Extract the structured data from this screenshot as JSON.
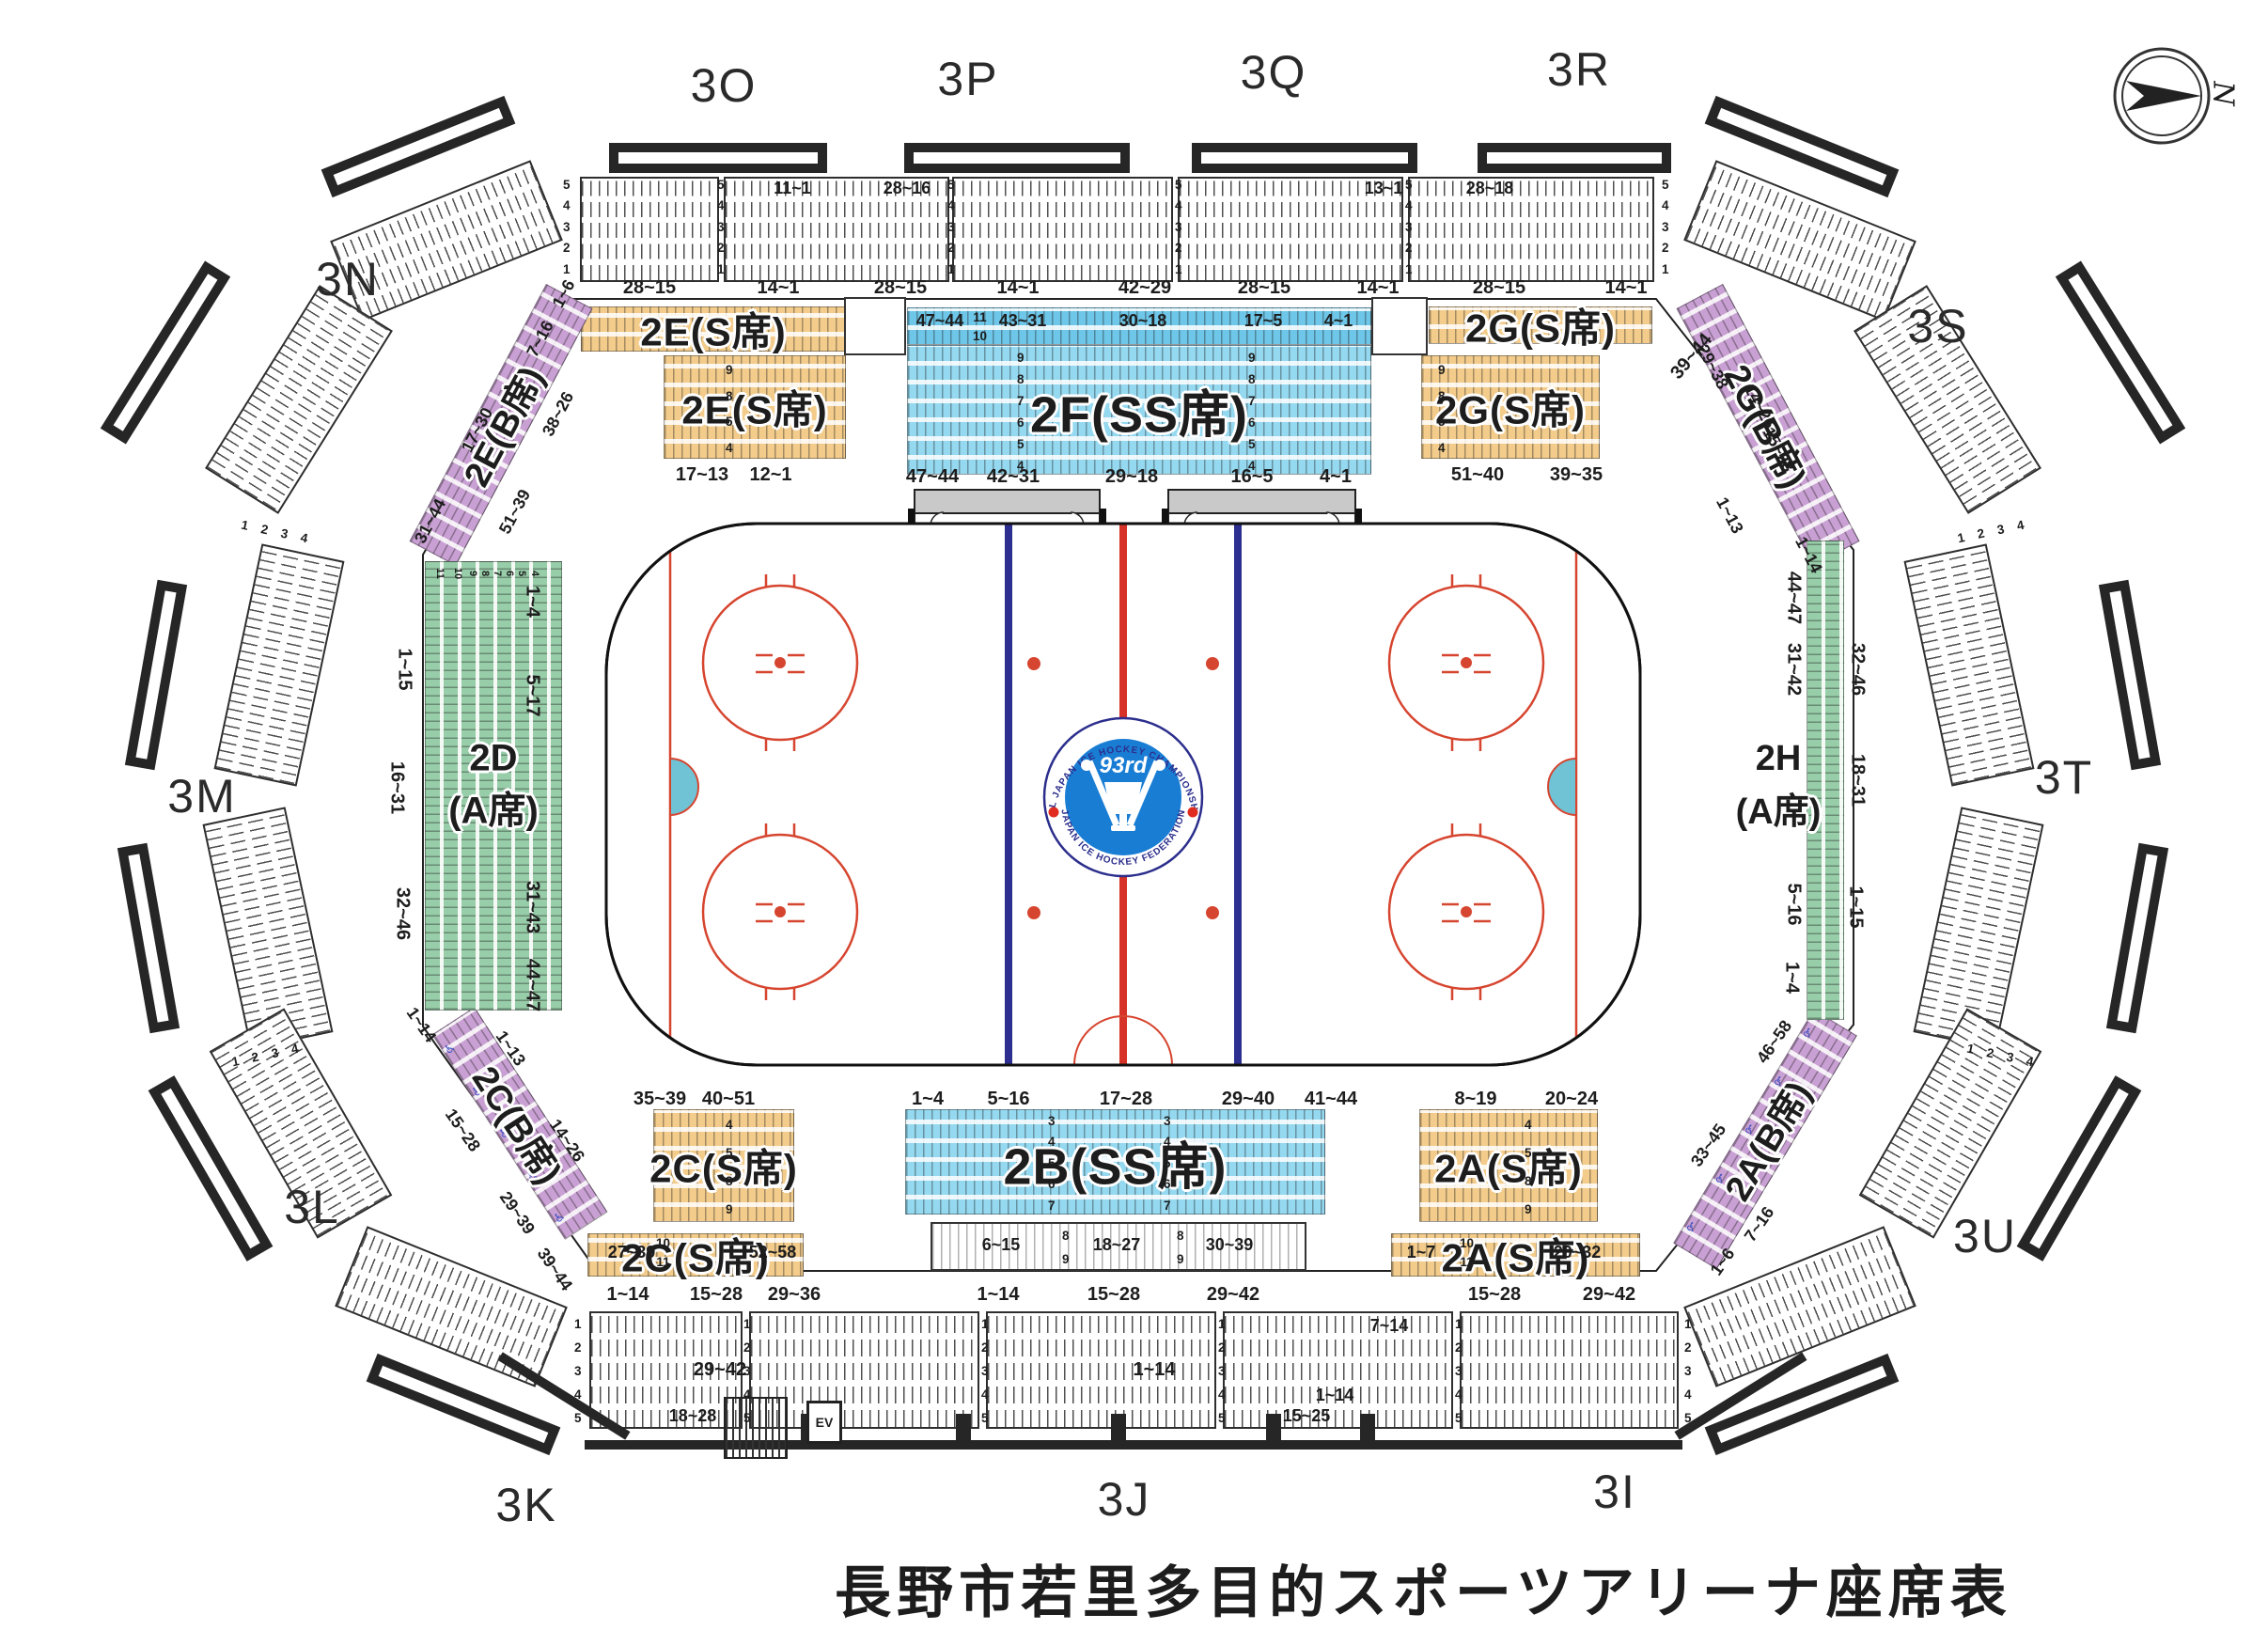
{
  "title": "長野市若里多目的スポーツアリーナ座席表",
  "compass_n": "N",
  "icons": {
    "wheelchair": "♿"
  },
  "logo": {
    "ordinal": "93rd",
    "arc_top": "ALL JAPAN ICE HOCKEY CHAMPIONSHIP",
    "arc_bottom": "JAPAN ICE HOCKEY FEDERATION"
  },
  "colors": {
    "s_seat": "#f3cc8b",
    "ss_seat": "#84d1ee",
    "a_seat": "#97cda8",
    "b_seat": "#c9a0d3",
    "bench": "#c9c9c9",
    "rink_red": "#d6452f",
    "rink_blue": "#2c2f8f",
    "crease": "#6fc3d4"
  },
  "ring": {
    "s3O": "3O",
    "s3P": "3P",
    "s3Q": "3Q",
    "s3R": "3R",
    "s3N": "3N",
    "s3M": "3M",
    "s3L": "3L",
    "s3K": "3K",
    "s3J": "3J",
    "s3I": "3I",
    "s3S": "3S",
    "s3T": "3T",
    "s3U": "3U",
    "rows_top": [
      "5",
      "4",
      "3",
      "2",
      "1"
    ],
    "rows_bottom": [
      "1",
      "2",
      "3",
      "4",
      "5"
    ],
    "rows_side": [
      "1",
      "2",
      "3",
      "4"
    ],
    "top_inline": [
      "11~1",
      "28~16",
      "13~1",
      "28~18"
    ],
    "top_below": [
      "28~15",
      "14~1",
      "28~15",
      "14~1",
      "42~29",
      "28~15",
      "14~1",
      "28~15",
      "14~1"
    ],
    "corner_tr": "39~44",
    "bottom_inline": [
      "7~14",
      "29~42",
      "1~14",
      "1~14",
      "18~28",
      "15~25"
    ],
    "ev": "EV"
  },
  "sections": {
    "e_strip": {
      "label": "2E(S席)"
    },
    "e_block": {
      "label": "2E(S席)",
      "rows": [
        "9",
        "8",
        "5",
        "4"
      ],
      "below": [
        "17~13",
        "12~1"
      ]
    },
    "f": {
      "label": "2F(SS席)",
      "strip_labels": [
        "47~44",
        "43~31",
        "30~18",
        "17~5",
        "4~1"
      ],
      "strip_rows": [
        "11",
        "10"
      ],
      "rows": [
        "9",
        "8",
        "7",
        "6",
        "5",
        "4"
      ],
      "below": [
        "47~44",
        "42~31",
        "29~18",
        "16~5",
        "4~1"
      ]
    },
    "g_strip": {
      "label": "2G(S席)"
    },
    "g_block": {
      "label": "2G(S席)",
      "rows": [
        "9",
        "8",
        "5",
        "4"
      ],
      "below": [
        "51~40",
        "39~35"
      ]
    },
    "eb": {
      "label": "2E(B席)",
      "ranges": [
        "1~6",
        "7~16",
        "38~26",
        "17~30",
        "51~39",
        "31~44"
      ]
    },
    "gb": {
      "label": "2G(B席)",
      "ranges": [
        "29~38",
        "14~26",
        "15~28",
        "1~13",
        "1~14"
      ]
    },
    "d": {
      "l1": "2D",
      "l2": "(A席)",
      "cols": [
        "1~4",
        "5~17",
        "31~43",
        "44~47"
      ],
      "inner": [
        "1~15",
        "16~31",
        "32~46"
      ],
      "col_nums": [
        "11",
        "10",
        "9",
        "8",
        "7",
        "6",
        "5",
        "4"
      ]
    },
    "h": {
      "l1": "2H",
      "l2": "(A席)",
      "outer": [
        "44~47",
        "31~42",
        "5~16",
        "1~4"
      ],
      "inner": [
        "32~46",
        "18~31",
        "1~15"
      ]
    },
    "cb": {
      "label": "2C(B席)",
      "ranges": [
        "1~14",
        "1~13",
        "15~28",
        "14~26",
        "29~39",
        "39~44"
      ]
    },
    "ab": {
      "label": "2A(B席)",
      "ranges": [
        "46~58",
        "33~45",
        "7~16",
        "1~6"
      ]
    },
    "c_block": {
      "label": "2C(S席)",
      "above": [
        "35~39",
        "40~51"
      ],
      "rows": [
        "4",
        "5",
        "8",
        "9"
      ]
    },
    "c_strip": {
      "label": "2C(S席)",
      "inline": [
        "27~39",
        "52~58"
      ],
      "rows": [
        "10",
        "11"
      ],
      "below": [
        "1~14",
        "15~28",
        "29~36"
      ]
    },
    "b": {
      "label": "2B(SS席)",
      "above": [
        "1~4",
        "5~16",
        "17~28",
        "29~40",
        "41~44"
      ],
      "rows": [
        "3",
        "4",
        "5",
        "6",
        "7"
      ],
      "sub": [
        "6~15",
        "18~27",
        "30~39"
      ],
      "sub_rows": [
        "8",
        "9"
      ],
      "below": [
        "1~14",
        "15~28",
        "29~42"
      ]
    },
    "a_block": {
      "label": "2A(S席)",
      "above": [
        "8~19",
        "20~24"
      ],
      "rows": [
        "4",
        "5",
        "8",
        "9"
      ]
    },
    "a_strip": {
      "label": "2A(S席)",
      "inline": [
        "1~7",
        "20~32"
      ],
      "rows": [
        "10",
        "11"
      ],
      "below": [
        "15~28",
        "29~42"
      ]
    }
  }
}
